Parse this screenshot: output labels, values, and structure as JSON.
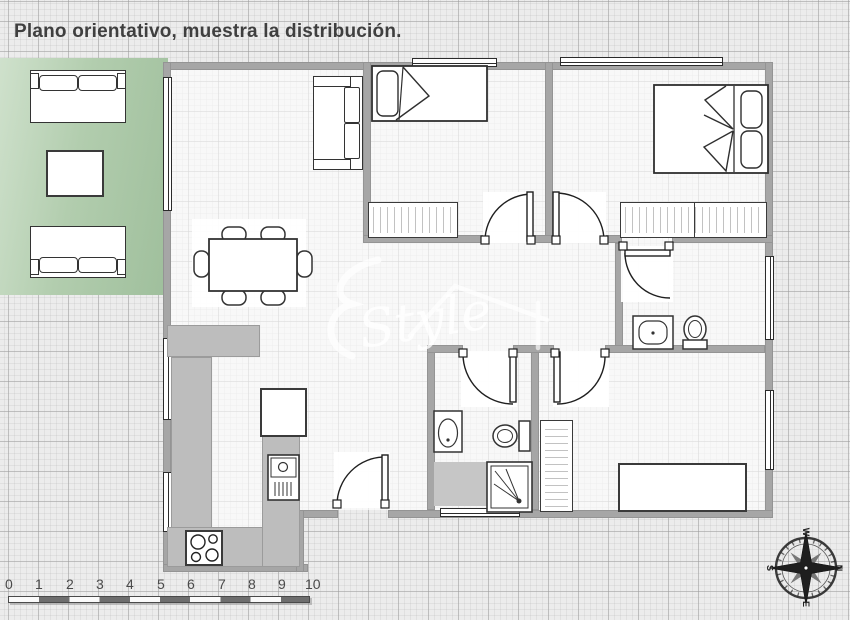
{
  "title": "Plano orientativo, muestra la distribución.",
  "watermark": {
    "brand": "Style"
  },
  "scale_ruler": {
    "labels": [
      "0",
      "1",
      "2",
      "3",
      "4",
      "5",
      "6",
      "7",
      "8",
      "9",
      "10"
    ]
  },
  "compass": {
    "north": "N",
    "east": "E",
    "south": "S",
    "west": "W"
  },
  "colors": {
    "terrace_green_light": "#cfe1cc",
    "terrace_green_dark": "#9fbf9c",
    "wall_gray": "#a6a6a6",
    "counter_gray": "#bdbdbd",
    "outline_dark": "#2b2b2b",
    "title_text": "#3f3f3f"
  }
}
